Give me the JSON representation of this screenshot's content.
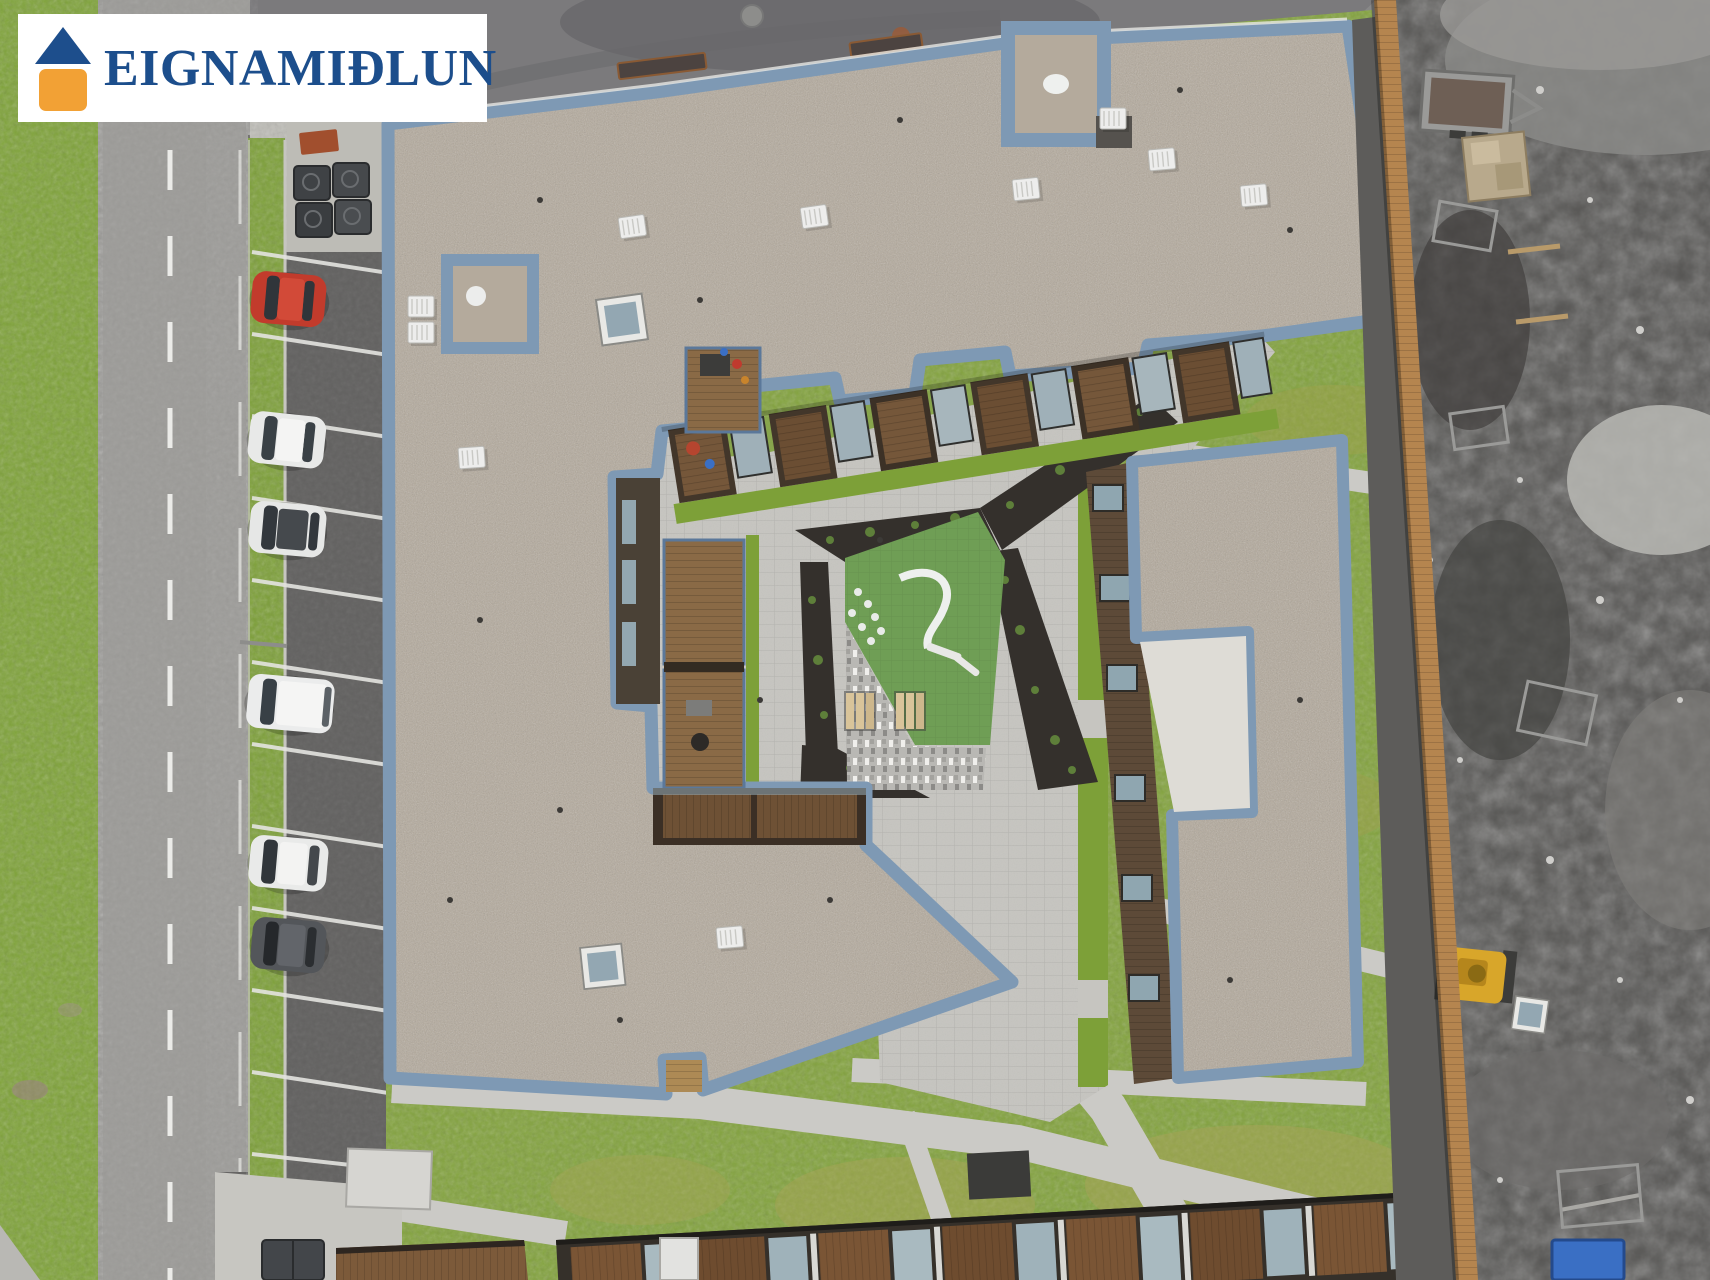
{
  "watermark": {
    "brand": "EIGNAMIÐLUN",
    "icon": "house-logo-icon",
    "colors": {
      "background": "#ffffff",
      "text": "#1c4e8c",
      "roof": "#1d4e8c",
      "wall": "#f2a135"
    }
  },
  "scene": {
    "type": "aerial-drone-photo-of-apartment-complex",
    "palette": {
      "roof_gravel": "#b4aa9c",
      "parapet_blue": "#7e99b4",
      "grass": "#83a33e",
      "road_asphalt": "#9c9b98",
      "street_asphalt": "#7b7a7c",
      "parking_asphalt": "#626160",
      "pavers": "#c6c5c0",
      "play_turf": "#6f9e55",
      "planting_soil": "#34302c",
      "wood_deck": "#7a5535",
      "fence_wood": "#b5854f",
      "construction_ground": "#565553",
      "red_car": "#c23b2c",
      "yellow_machine": "#d8a62a",
      "blue_portable_toilet": "#3a6fc4"
    },
    "counts": {
      "parked_cars": 6,
      "picnic_benches": 2
    }
  }
}
